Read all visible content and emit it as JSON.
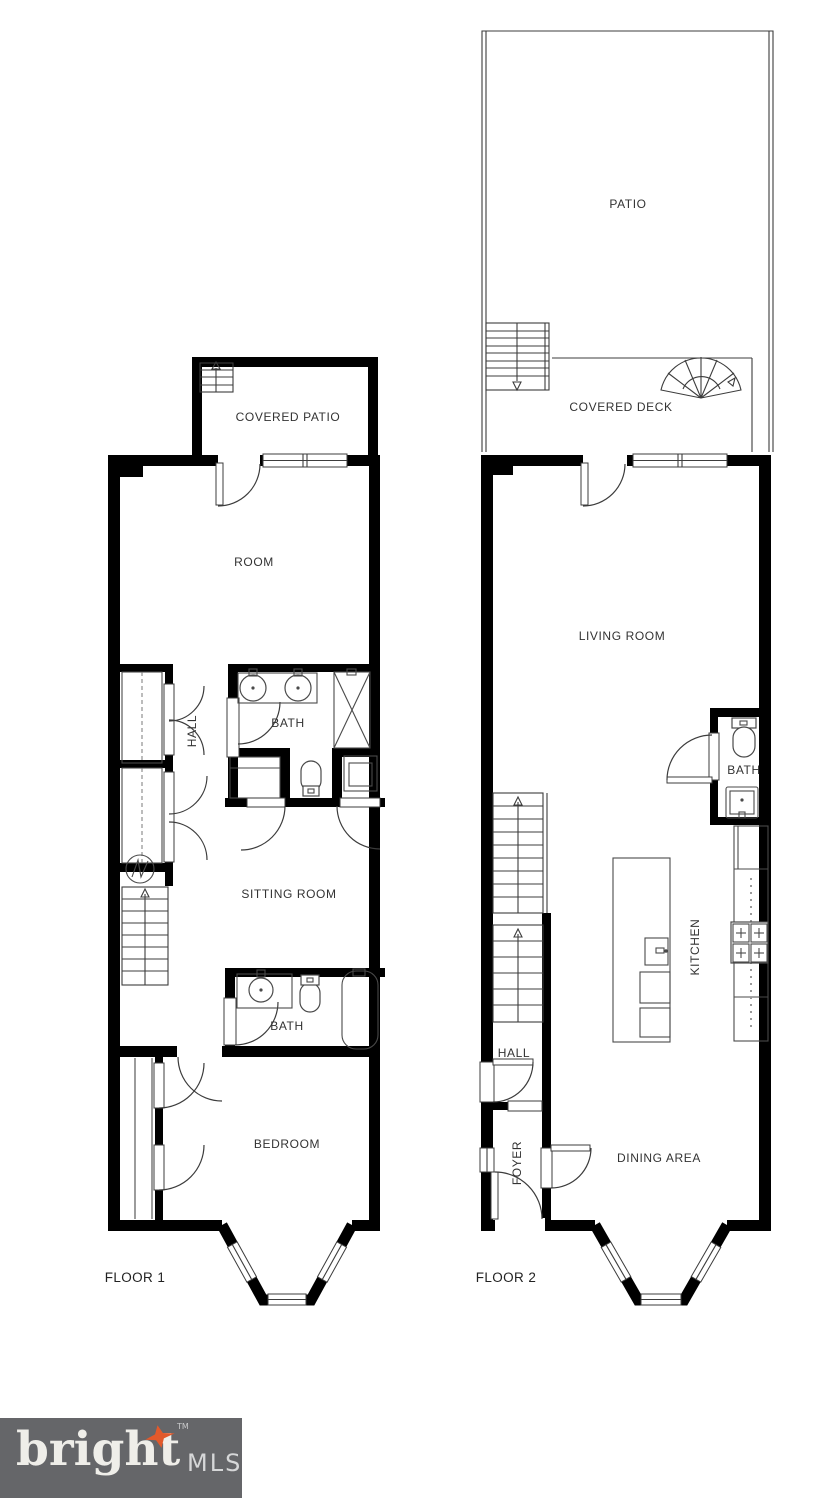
{
  "floor1": {
    "name": "FLOOR 1",
    "labels": {
      "covered_patio": "COVERED PATIO",
      "room": "ROOM",
      "hall": "HALL",
      "bath_upper": "BATH",
      "sitting_room": "SITTING ROOM",
      "bath_lower": "BATH",
      "bedroom": "BEDROOM"
    }
  },
  "floor2": {
    "name": "FLOOR 2",
    "labels": {
      "patio": "PATIO",
      "covered_deck": "COVERED DECK",
      "living_room": "LIVING ROOM",
      "bath": "BATH",
      "kitchen": "KITCHEN",
      "hall": "HALL",
      "foyer": "FOYER",
      "dining_area": "DINING AREA"
    }
  },
  "logo": {
    "brand": "bright",
    "tm": "TM",
    "suffix": "MLS",
    "colors": {
      "bar": "#656669",
      "brand_text": "#efeee9",
      "suffix_text": "#d6d7d8",
      "star": "#e2592b"
    }
  },
  "plan_colors": {
    "wall": "#000000",
    "background": "#ffffff",
    "fixture_line": "#4a4a4a",
    "label_text": "#333333"
  }
}
